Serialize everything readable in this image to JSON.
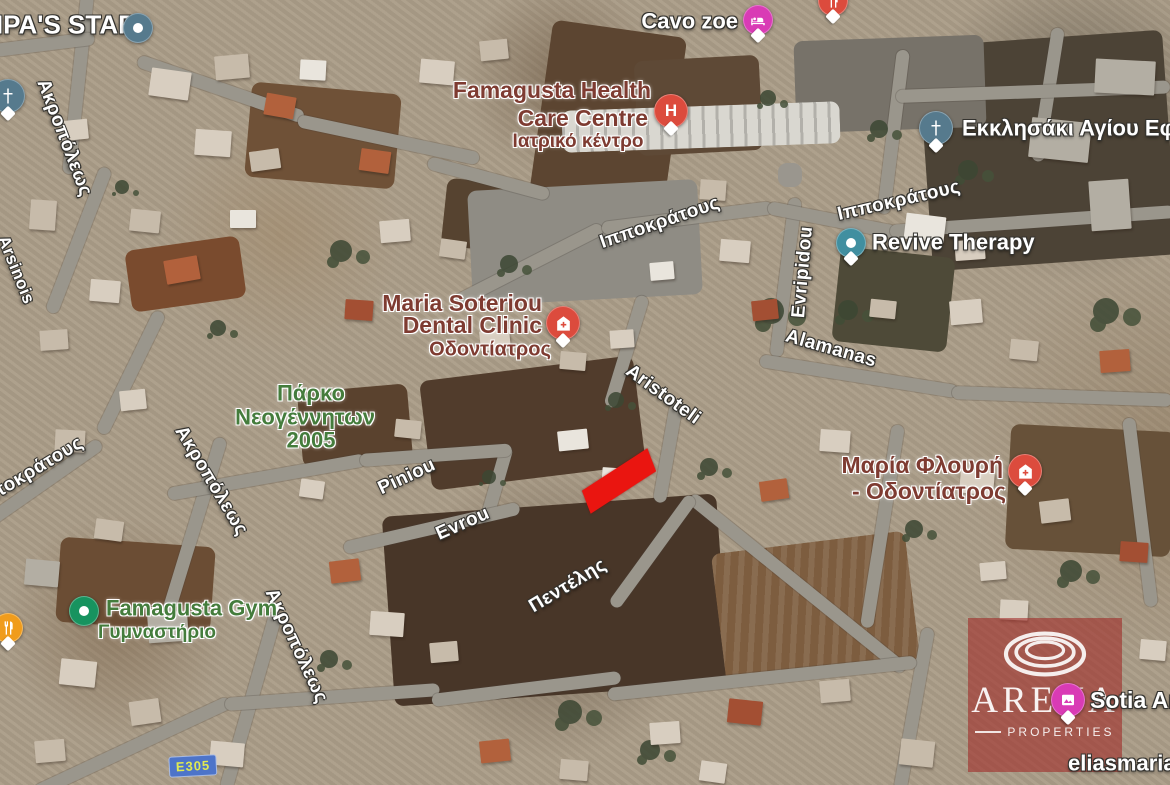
{
  "map_type": "satellite",
  "roads": {
    "akropoleos_1": "Ακροπόλεως",
    "akropoleos_2": "Ακροπόλεως",
    "akropoleos_3": "Ακροπόλεως",
    "arsinois": "Arsinois",
    "ippokratous_left": "Ιπποκράτους",
    "ippokratous_1": "Ιπποκράτους",
    "ippokratous_2": "Ιπποκράτους",
    "evripidou": "Evripidou",
    "alamanas": "Alamanas",
    "aristoteli": "Aristoteli",
    "piniou": "Piniou",
    "evrou": "Evrou",
    "pentelis": "Πεντέλης",
    "e305": "E305"
  },
  "pois": {
    "nipas_star": "NIPA'S STAR",
    "cavo_zoe": "Cavo zoe",
    "hospital_h": "H",
    "famagusta_health": {
      "line1": "Famagusta Health",
      "line2": "Care Centre",
      "sub": "Ιατρικό κέντρο"
    },
    "ekklisaki": "Εκκλησάκι Αγίου Εφρα",
    "revive_therapy": "Revive Therapy",
    "maria_soteriou": {
      "line1": "Maria Soteriou",
      "line2": "Dental Clinic",
      "sub": "Οδοντίατρος"
    },
    "parko": {
      "line1": "Πάρκο",
      "line2": "Νεογέννητων",
      "line3": "2005"
    },
    "maria_flouri": {
      "line1": "Μαρία Φλουρή",
      "line2": "- Οδοντίατρος"
    },
    "famagusta_gym": {
      "line1": "Famagusta Gym",
      "sub": "Γυμναστήριο"
    },
    "sotia_art": "Sotia Art",
    "eliasmaria": "eliasmaria"
  },
  "watermark": {
    "brand": "ARENA",
    "sub": "PROPERTIES"
  },
  "colors": {
    "marker_red": "#dc4b3d",
    "marker_pink": "#d93bb5",
    "marker_teal": "#418fa0",
    "marker_bluegray": "#567a8d",
    "marker_green": "#17935f",
    "marker_amber": "#f09c1c",
    "highlight_red": "#ea1510",
    "label_medical": "#7e3b31",
    "label_green": "#447c3c",
    "e305_bg": "#4d74c9",
    "e305_text": "#e0ea52",
    "road_fill": "#9a968c"
  }
}
